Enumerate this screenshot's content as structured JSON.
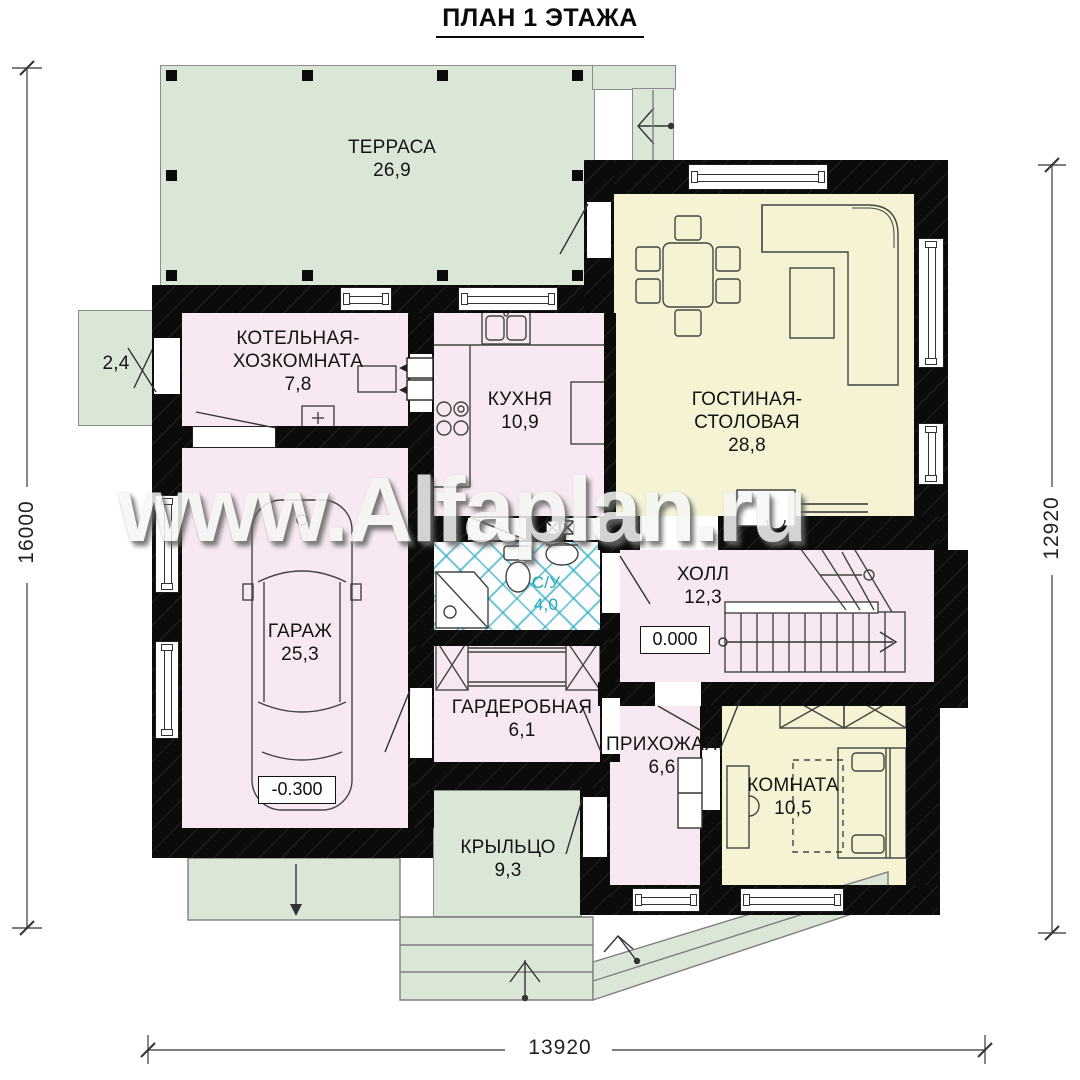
{
  "title": "ПЛАН 1 ЭТАЖА",
  "watermark": "www.Alfaplan.ru",
  "dimensions": {
    "left": "16000",
    "right": "12920",
    "bottom": "13920"
  },
  "rooms": {
    "terrace": {
      "name": "ТЕРРАСА",
      "area": "26,9"
    },
    "side_terrace": {
      "area": "2,4"
    },
    "boiler": {
      "name_line1": "КОТЕЛЬНАЯ-",
      "name_line2": "ХОЗКОМНАТА",
      "area": "7,8"
    },
    "kitchen": {
      "name": "КУХНЯ",
      "area": "10,9"
    },
    "living": {
      "name_line1": "ГОСТИНАЯ-",
      "name_line2": "СТОЛОВАЯ",
      "area": "28,8"
    },
    "garage": {
      "name": "ГАРАЖ",
      "area": "25,3",
      "level": "-0.300"
    },
    "bathroom": {
      "name": "С/У",
      "area": "4,0"
    },
    "hall": {
      "name": "ХОЛЛ",
      "area": "12,3",
      "level": "0.000"
    },
    "wardrobe": {
      "name": "ГАРДЕРОБНАЯ",
      "area": "6,1"
    },
    "entry": {
      "name": "ПРИХОЖАЯ",
      "area": "6,6"
    },
    "room": {
      "name": "КОМНАТА",
      "area": "10,5"
    },
    "porch": {
      "name": "КРЫЛЬЦО",
      "area": "9,3"
    }
  },
  "colors": {
    "terrace_green": "#dbe7d6",
    "room_pink": "#f7e8f1",
    "living_cream": "#f5f3d3",
    "wall_black": "#0b0b0b",
    "tile_teal": "#2aaac3",
    "bath_text_teal": "#1fa7bd"
  }
}
